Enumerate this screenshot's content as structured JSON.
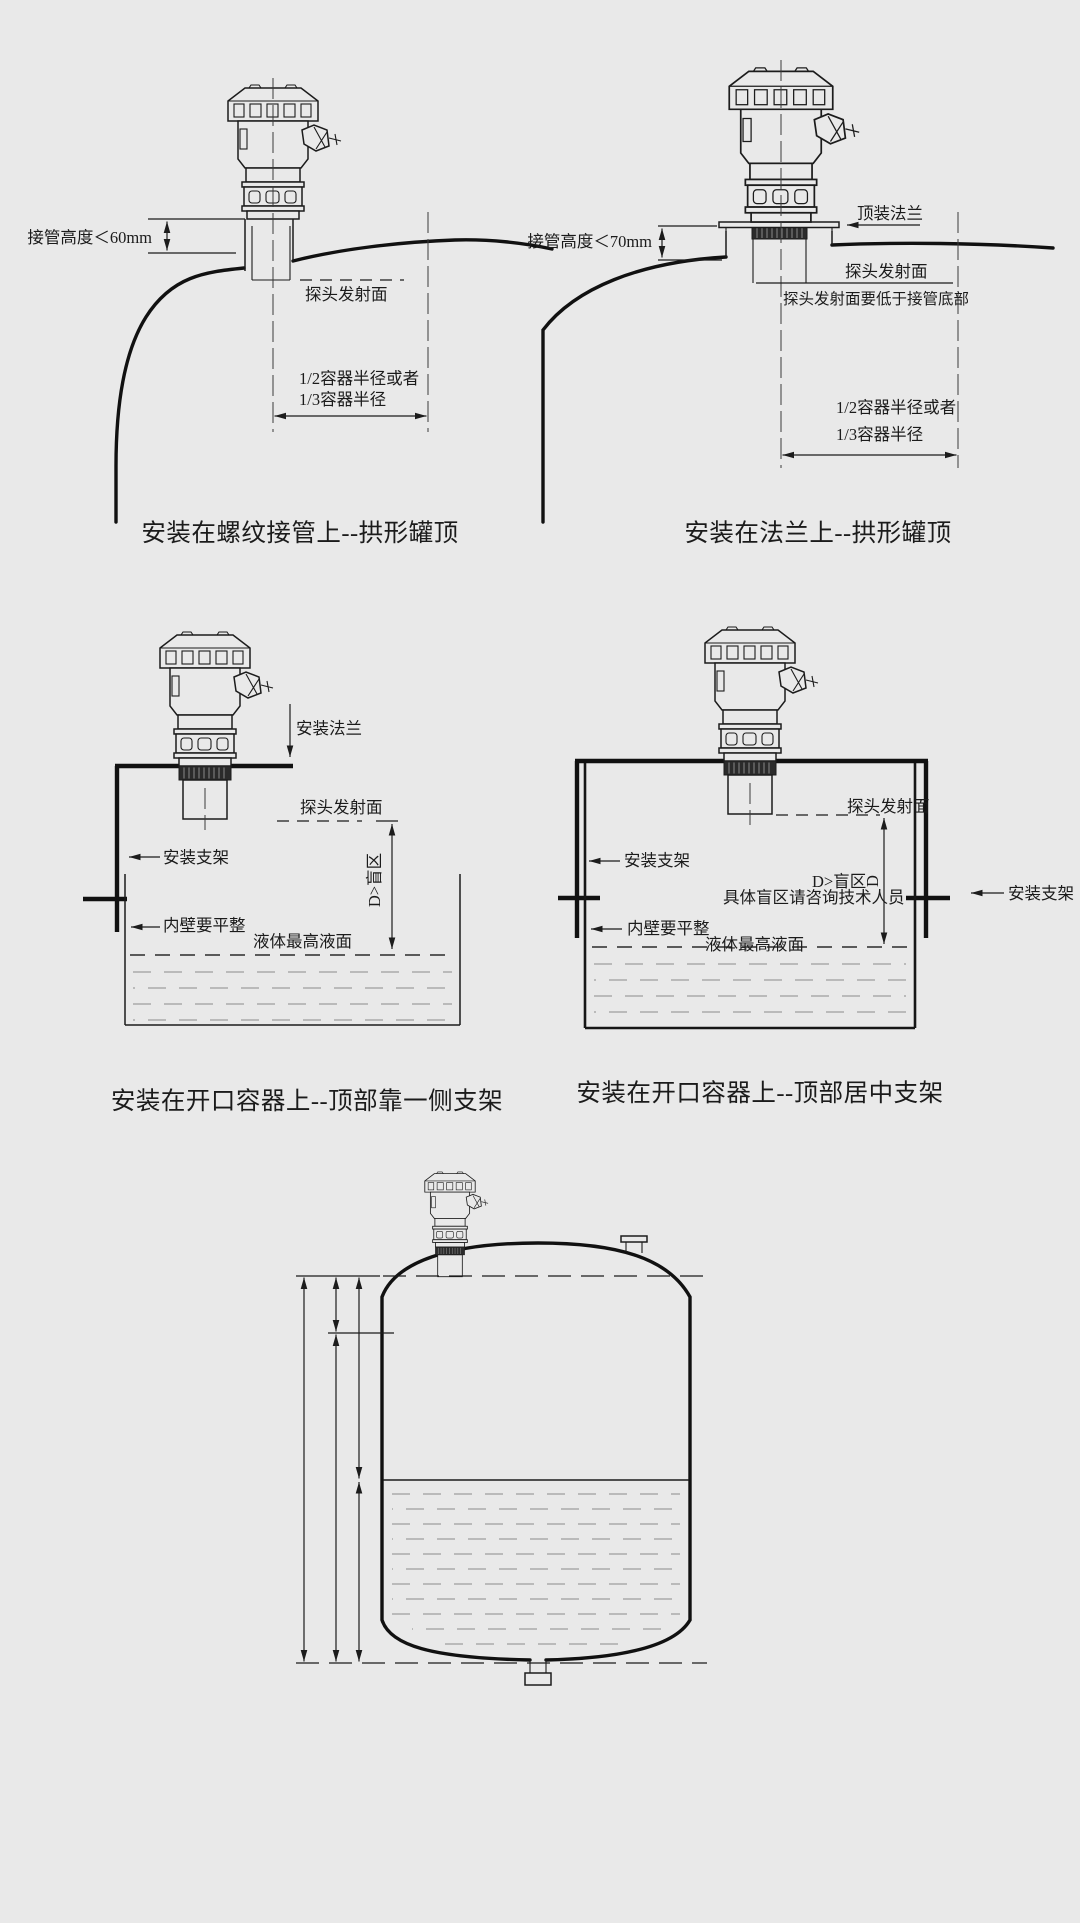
{
  "colors": {
    "background": "#e9e9e9",
    "line": "#1c1c1c",
    "liquid_dash": "#9f9f9f"
  },
  "diagrams": {
    "top_left": {
      "caption": "安装在螺纹接管上--拱形罐顶",
      "labels": {
        "nozzle_height": "接管高度＜60mm",
        "emitting_face": "探头发射面",
        "radius_line1": "1/2容器半径或者",
        "radius_line2": "1/3容器半径"
      }
    },
    "top_right": {
      "caption": "安装在法兰上--拱形罐顶",
      "labels": {
        "top_flange": "顶装法兰",
        "nozzle_height": "接管高度＜70mm",
        "emitting_face": "探头发射面",
        "emitting_face_note": "探头发射面要低于接管底部",
        "radius_line1": "1/2容器半径或者",
        "radius_line2": "1/3容器半径"
      }
    },
    "middle_left": {
      "caption": "安装在开口容器上--顶部靠一侧支架",
      "labels": {
        "mounting_flange": "安装法兰",
        "emitting_face": "探头发射面",
        "bracket": "安装支架",
        "blind_zone": "D>盲区",
        "inner_wall": "内壁要平整",
        "max_level": "液体最高液面"
      }
    },
    "middle_right": {
      "caption": "安装在开口容器上--顶部居中支架",
      "labels": {
        "emitting_face": "探头发射面",
        "blind_zone": "D>盲区",
        "dim_d": "D",
        "blind_zone_note": "具体盲区请咨询技术人员",
        "bracket_left": "安装支架",
        "bracket_right": "安装支架",
        "inner_wall": "内壁要平整",
        "max_level": "液体最高液面"
      }
    },
    "bottom": {
      "dims": {
        "bd": "BD",
        "d": "D",
        "h": "H",
        "f": "F",
        "l": "L"
      },
      "top_current": "20mA",
      "top_percent": "100%",
      "bottom_current": "4mA",
      "bottom_percent": "0%",
      "description_line1": "利用超声波在遇到不同密度的介质分界面时",
      "description_line2": "发生反射，通过测定传输时间来测量液位。",
      "legend": [
        "BD：盲区距离",
        "H：安装高度",
        "F：测量范围",
        "D：传感器膜片至物料表面间的距离",
        "L：液位"
      ]
    }
  }
}
